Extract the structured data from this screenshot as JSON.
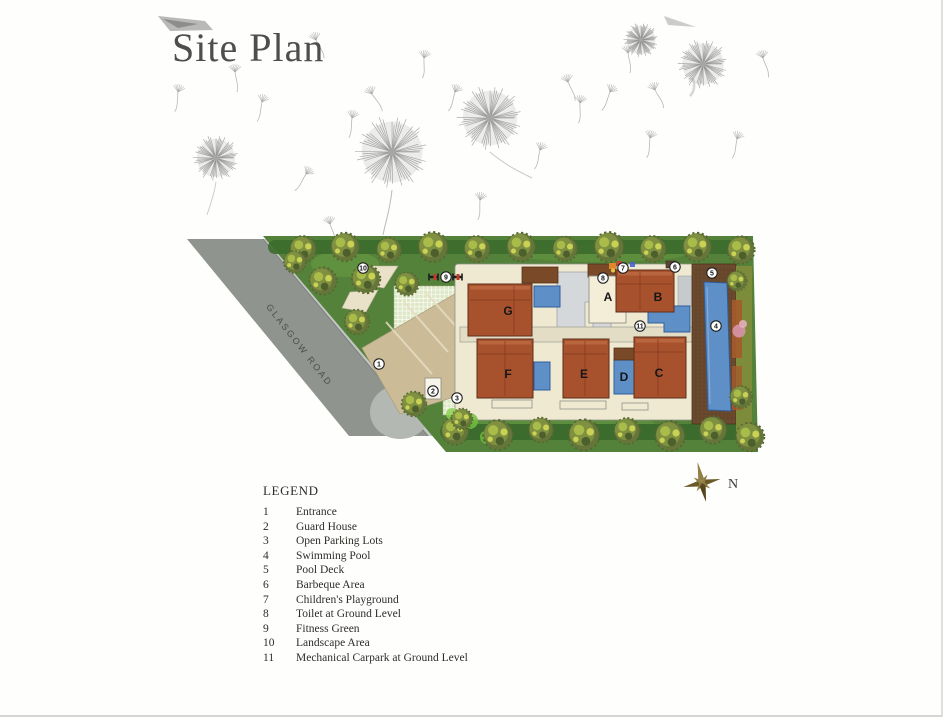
{
  "page": {
    "title": "Site Plan"
  },
  "plan": {
    "road_label": "GLASGOW ROAD",
    "compass_label": "N",
    "buildings": [
      {
        "label": "A"
      },
      {
        "label": "B"
      },
      {
        "label": "C"
      },
      {
        "label": "D"
      },
      {
        "label": "E"
      },
      {
        "label": "F"
      },
      {
        "label": "G"
      }
    ],
    "markers": [
      {
        "number": "1"
      },
      {
        "number": "2"
      },
      {
        "number": "3"
      },
      {
        "number": "4"
      },
      {
        "number": "5"
      },
      {
        "number": "6"
      },
      {
        "number": "7"
      },
      {
        "number": "8"
      },
      {
        "number": "9"
      },
      {
        "number": "10"
      },
      {
        "number": "11"
      }
    ]
  },
  "legend": {
    "title": "LEGEND",
    "items": [
      {
        "number": "1",
        "label": "Entrance"
      },
      {
        "number": "2",
        "label": "Guard House"
      },
      {
        "number": "3",
        "label": "Open Parking Lots"
      },
      {
        "number": "4",
        "label": "Swimming Pool"
      },
      {
        "number": "5",
        "label": "Pool Deck"
      },
      {
        "number": "6",
        "label": "Barbeque Area"
      },
      {
        "number": "7",
        "label": "Children's Playground"
      },
      {
        "number": "8",
        "label": "Toilet at Ground Level"
      },
      {
        "number": "9",
        "label": "Fitness Green"
      },
      {
        "number": "10",
        "label": "Landscape Area"
      },
      {
        "number": "11",
        "label": "Mechanical Carpark at Ground Level"
      }
    ]
  },
  "colors": {
    "building": "#a8512d",
    "building-dark": "#7a4a28",
    "pool": "#5f8fc7",
    "lawn": "#55823b",
    "cream": "#f0e9d2",
    "road": "#8f948f",
    "sidewalk": "#c3c6c2",
    "deck": "#6b4a2e",
    "paver": "#dee8c6",
    "driveway": "#cbbc97",
    "hedge": "#3c6b2e",
    "ink": "#2f2d29",
    "title-ink": "#4e4e4c"
  }
}
